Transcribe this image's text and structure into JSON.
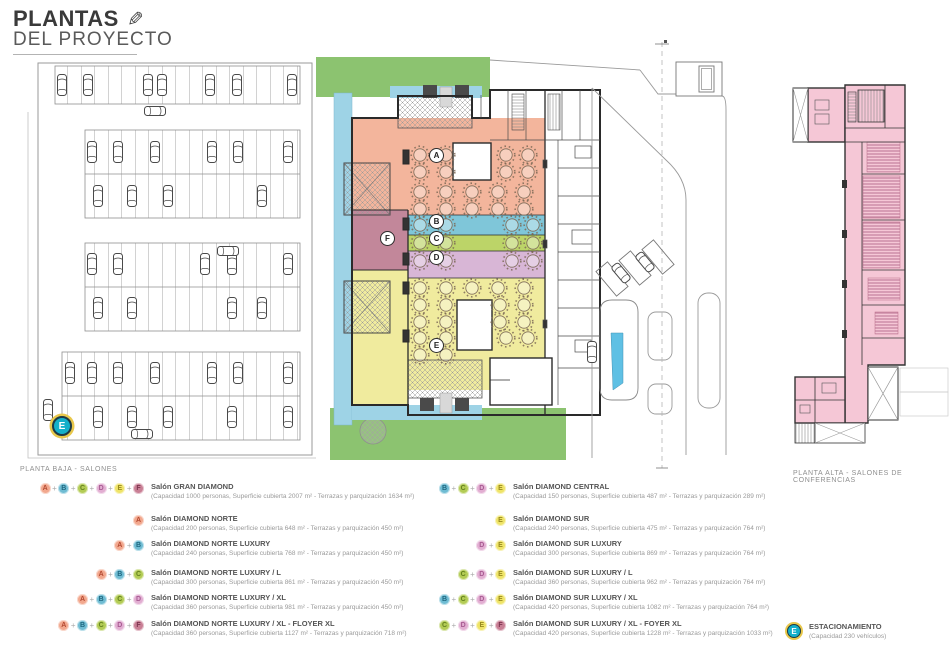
{
  "header": {
    "title_line1": "PLANTAS",
    "title_line2": "DEL PROYECTO",
    "pencil_icon": "✎"
  },
  "section_labels": {
    "planta_baja": "PLANTA BAJA - SALONES",
    "planta_alta": "PLANTA ALTA - SALONES DE CONFERENCIAS"
  },
  "zone_colors": {
    "A": {
      "bg": "#f2a88e",
      "fg": "#b44a32"
    },
    "B": {
      "bg": "#6fbcd3",
      "fg": "#1f6880"
    },
    "C": {
      "bg": "#b3cc55",
      "fg": "#64801f"
    },
    "D": {
      "bg": "#e2aed2",
      "fg": "#a85a92"
    },
    "E": {
      "bg": "#efe468",
      "fg": "#988a1f"
    },
    "F": {
      "bg": "#c97f95",
      "fg": "#7d3550"
    },
    "parking": {
      "bg": "#14b0ca",
      "fg": "#ffffff",
      "ring": "#e8c74b"
    }
  },
  "plan_markers": {
    "A": "A",
    "B": "B",
    "C": "C",
    "D": "D",
    "E": "E",
    "F": "F",
    "parking": "E"
  },
  "legend_left": [
    {
      "badges": [
        "A",
        "B",
        "C",
        "D",
        "E",
        "F"
      ],
      "title": "Salón GRAN DIAMOND",
      "details": "(Capacidad 1000 personas, Superficie cubierta 2007 m² - Terrazas y parquización 1634 m²)"
    },
    {
      "badges": [
        "A"
      ],
      "title": "Salón DIAMOND NORTE",
      "details": "(Capacidad 200 personas, Superficie cubierta 648 m² - Terrazas y parquización 450 m²)"
    },
    {
      "badges": [
        "A",
        "B"
      ],
      "title": "Salón DIAMOND NORTE LUXURY",
      "details": "(Capacidad 240 personas, Superficie cubierta 768 m² - Terrazas y parquización 450 m²)"
    },
    {
      "badges": [
        "A",
        "B",
        "C"
      ],
      "title": "Salón DIAMOND NORTE LUXURY / L",
      "details": "(Capacidad 300 personas, Superficie cubierta 861 m² - Terrazas y parquización 450 m²)"
    },
    {
      "badges": [
        "A",
        "B",
        "C",
        "D"
      ],
      "title": "Salón DIAMOND NORTE LUXURY / XL",
      "details": "(Capacidad 360 personas, Superficie cubierta 981 m² - Terrazas y parquización 450 m²)"
    },
    {
      "badges": [
        "A",
        "B",
        "C",
        "D",
        "F"
      ],
      "title": "Salón DIAMOND NORTE LUXURY / XL - FLOYER XL",
      "details": "(Capacidad 360 personas, Superficie cubierta 1127 m² - Terrazas y parquización 718 m²)"
    }
  ],
  "legend_right": [
    {
      "badges": [
        "B",
        "C",
        "D",
        "E"
      ],
      "title": "Salón DIAMOND CENTRAL",
      "details": "(Capacidad 150 personas, Superficie cubierta 487 m² - Terrazas y parquización 289 m²)"
    },
    {
      "badges": [
        "E"
      ],
      "title": "Salón DIAMOND SUR",
      "details": "(Capacidad 240 personas, Superficie cubierta 475 m² - Terrazas y parquización 764 m²)"
    },
    {
      "badges": [
        "D",
        "E"
      ],
      "title": "Salón DIAMOND SUR LUXURY",
      "details": "(Capacidad 300 personas, Superficie cubierta 869 m² - Terrazas y parquización 764 m²)"
    },
    {
      "badges": [
        "C",
        "D",
        "E"
      ],
      "title": "Salón DIAMOND SUR LUXURY / L",
      "details": "(Capacidad 360 personas, Superficie cubierta 962 m² - Terrazas y parquización 764 m²)"
    },
    {
      "badges": [
        "B",
        "C",
        "D",
        "E"
      ],
      "title": "Salón DIAMOND SUR LUXURY / XL",
      "details": "(Capacidad 420 personas, Superficie cubierta 1082 m² - Terrazas y parquización 764 m²)"
    },
    {
      "badges": [
        "C",
        "D",
        "E",
        "F"
      ],
      "title": "Salón DIAMOND SUR LUXURY / XL - FOYER XL",
      "details": "(Capacidad 420 personas, Superficie cubierta 1228 m² - Terrazas y parquización 1033 m²)"
    }
  ],
  "parking_legend": {
    "badge": "E",
    "title": "ESTACIONAMIENTO",
    "details": "(Capacidad 230 vehículos)"
  }
}
